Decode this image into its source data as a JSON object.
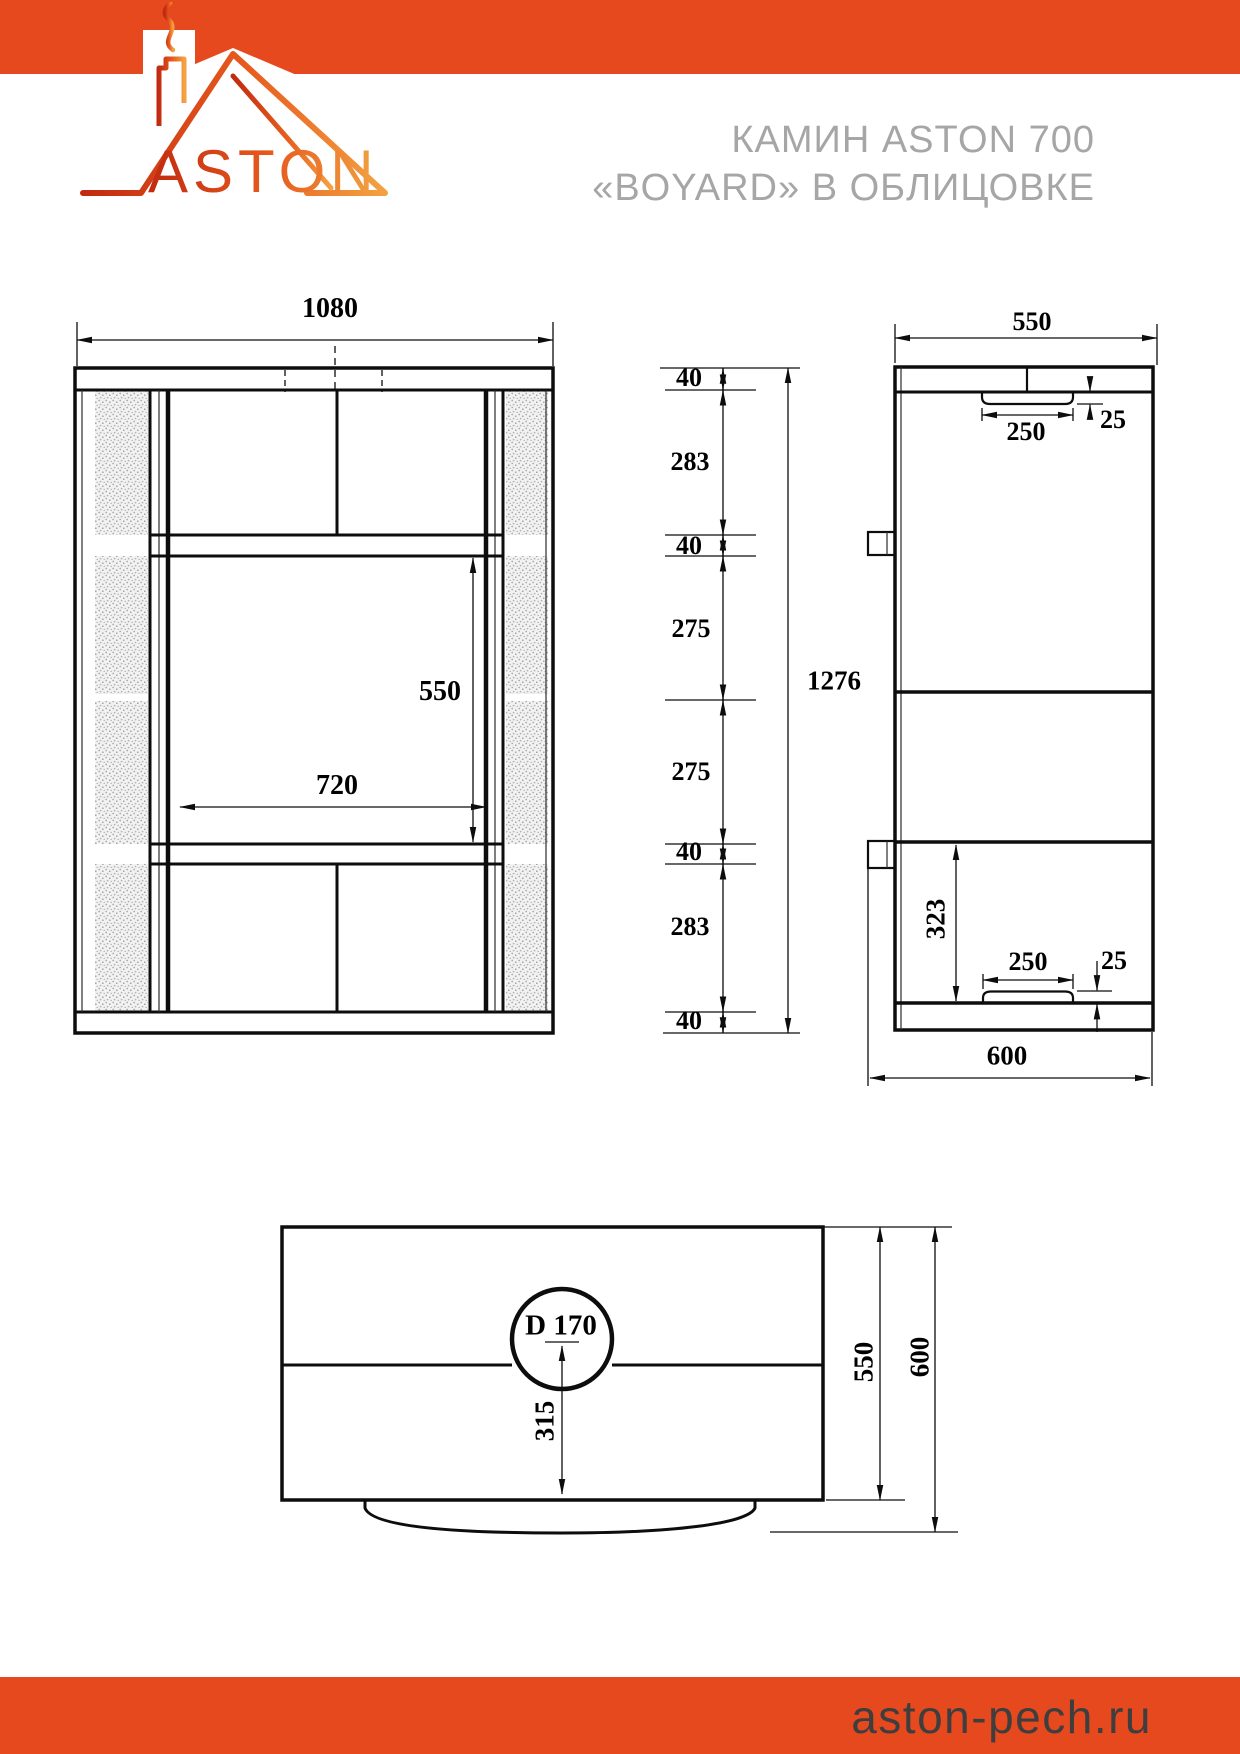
{
  "header": {
    "brand": "ASTON",
    "title_line1": "КАМИН ASTON 700",
    "title_line2": "«BOYARD» В ОБЛИЦОВКЕ"
  },
  "footer": {
    "site": "aston-pech.ru"
  },
  "colors": {
    "accent_orange": "#E7491F",
    "logo_gradient_start": "#C62B12",
    "logo_gradient_end": "#F2A242",
    "title_gray": "#A6A6A6",
    "footer_text": "#3E3E3E",
    "line_black": "#0D0D0D"
  },
  "dimensions_mm": {
    "front_view": {
      "overall_width": "1080",
      "opening_width": "720",
      "opening_height": "550",
      "height_chain": [
        "40",
        "283",
        "40",
        "275",
        "275",
        "40",
        "283",
        "40"
      ],
      "overall_height": "1276"
    },
    "side_view": {
      "body_depth": "550",
      "top_duct_width": "250",
      "top_duct_height": "25",
      "lower_section_height": "323",
      "bottom_duct_width": "250",
      "bottom_duct_height": "25",
      "overall_depth": "600"
    },
    "top_view": {
      "chimney_diameter": "D 170",
      "chimney_axis_offset": "315",
      "body_depth": "550",
      "overall_depth": "600"
    }
  },
  "drawing": {
    "labels": [
      {
        "id": "front-width",
        "text": "1080",
        "x": 330,
        "y": 309,
        "size": 28
      },
      {
        "id": "firebox-height",
        "text": "550",
        "x": 440,
        "y": 692,
        "size": 28
      },
      {
        "id": "firebox-width",
        "text": "720",
        "x": 337,
        "y": 786,
        "size": 28
      },
      {
        "id": "chain-40-a",
        "text": "40",
        "x": 689,
        "y": 378,
        "size": 26
      },
      {
        "id": "chain-283-a",
        "text": "283",
        "x": 690,
        "y": 462,
        "size": 26
      },
      {
        "id": "chain-40-b",
        "text": "40",
        "x": 689,
        "y": 546,
        "size": 26
      },
      {
        "id": "chain-275-a",
        "text": "275",
        "x": 691,
        "y": 629,
        "size": 26
      },
      {
        "id": "chain-275-b",
        "text": "275",
        "x": 691,
        "y": 772,
        "size": 26
      },
      {
        "id": "chain-40-c",
        "text": "40",
        "x": 689,
        "y": 852,
        "size": 26
      },
      {
        "id": "chain-283-b",
        "text": "283",
        "x": 690,
        "y": 927,
        "size": 26
      },
      {
        "id": "chain-40-d",
        "text": "40",
        "x": 689,
        "y": 1021,
        "size": 26
      },
      {
        "id": "total-height",
        "text": "1276",
        "x": 834,
        "y": 681,
        "size": 27
      },
      {
        "id": "side-depth",
        "text": "550",
        "x": 1032,
        "y": 322,
        "size": 26
      },
      {
        "id": "flue-top-width",
        "text": "250",
        "x": 1026,
        "y": 432,
        "size": 26
      },
      {
        "id": "flue-top-height",
        "text": "25",
        "x": 1113,
        "y": 420,
        "size": 26
      },
      {
        "id": "side-323",
        "text": "323",
        "x": 936,
        "y": 919,
        "rot": -90,
        "size": 27
      },
      {
        "id": "flue-bottom-width",
        "text": "250",
        "x": 1028,
        "y": 962,
        "size": 26
      },
      {
        "id": "flue-bottom-height",
        "text": "25",
        "x": 1114,
        "y": 961,
        "size": 26
      },
      {
        "id": "base-depth",
        "text": "600",
        "x": 1007,
        "y": 1056,
        "size": 27
      },
      {
        "id": "chimney-diameter",
        "text": "D 170",
        "x": 561,
        "y": 1326,
        "size": 29
      },
      {
        "id": "top-315",
        "text": "315",
        "x": 545,
        "y": 1421,
        "rot": -90,
        "size": 27
      },
      {
        "id": "top-550",
        "text": "550",
        "x": 864,
        "y": 1362,
        "rot": -90,
        "size": 27
      },
      {
        "id": "top-600",
        "text": "600",
        "x": 920,
        "y": 1357,
        "rot": -90,
        "size": 27
      }
    ]
  }
}
